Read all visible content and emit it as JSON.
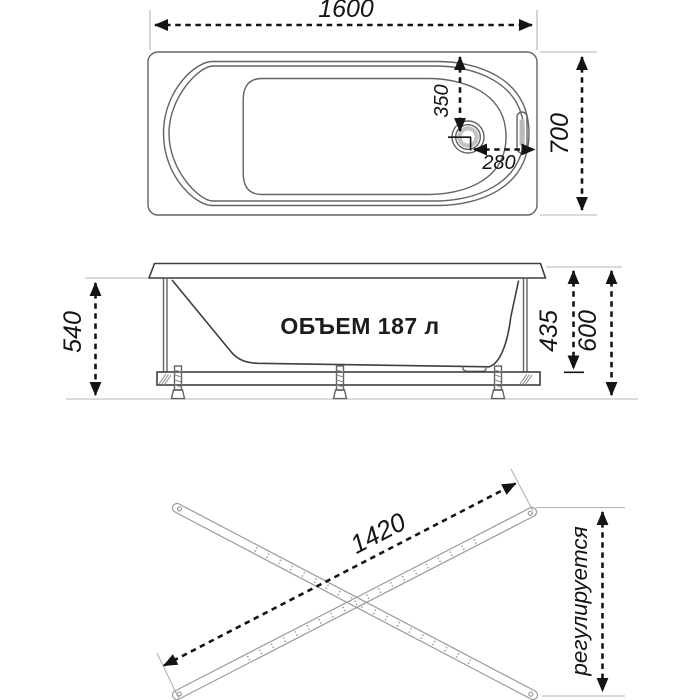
{
  "top_view": {
    "length_label": "1600",
    "width_label": "700",
    "drain_offset_vertical_label": "350",
    "drain_offset_horizontal_label": "280"
  },
  "side_view": {
    "apron_height_label": "540",
    "inner_depth_label": "435",
    "total_height_label": "600",
    "volume_label": "ОБЪЕМ 187 л"
  },
  "frame_view": {
    "rail_length_label": "1420",
    "adjustable_label": "регулируется"
  },
  "colors": {
    "background": "#ffffff",
    "dimension_line": "#141414",
    "drawing_line": "#636363",
    "drawing_line_dark": "#3f3f3f",
    "extension_line": "#b4b4b8",
    "rail_line": "#9a9a9a",
    "drain_shade": "#c4c4c4",
    "overflow_shade": "#b9b9b9"
  }
}
